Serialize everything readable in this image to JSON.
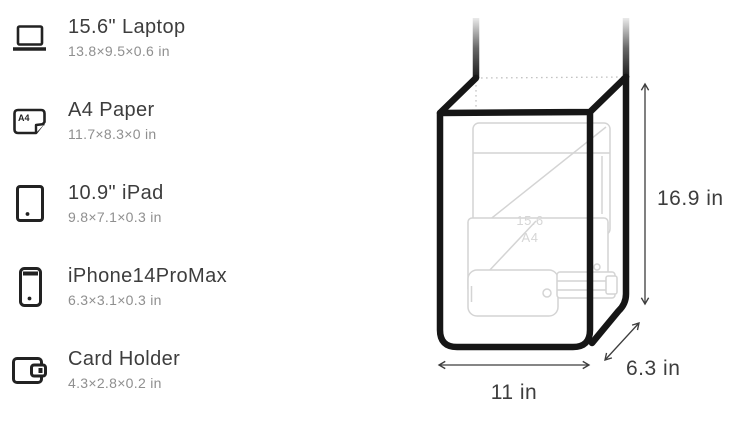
{
  "capacity_list": {
    "items": [
      {
        "name": "15.6\" Laptop",
        "dimensions": "13.8×9.5×0.6 in"
      },
      {
        "name": "A4 Paper",
        "dimensions": "11.7×8.3×0 in"
      },
      {
        "name": "10.9\" iPad",
        "dimensions": "9.8×7.1×0.3 in"
      },
      {
        "name": "iPhone14ProMax",
        "dimensions": "6.3×3.1×0.3 in"
      },
      {
        "name": "Card Holder",
        "dimensions": "4.3×2.8×0.2 in"
      }
    ],
    "a4_icon_badge": "A4"
  },
  "diagram": {
    "height_label": "16.9 in",
    "width_label": "11 in",
    "depth_label": "6.3 in",
    "inner_item_labels": {
      "laptop": "15.6",
      "a4_paper": "A4"
    },
    "colors": {
      "bag_outline": "#161616",
      "dimension_lines": "#3d3d3d",
      "faint_items": "#d4d4d4"
    }
  }
}
